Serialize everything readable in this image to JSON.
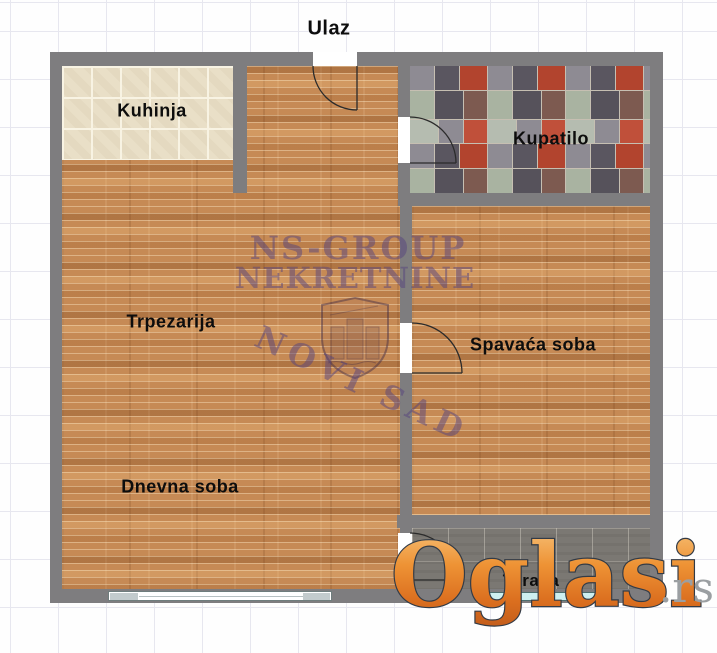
{
  "plan": {
    "entrance_label": "Ulaz",
    "rooms": {
      "kitchen": "Kuhinja",
      "bathroom": "Kupatilo",
      "dining": "Trpezarija",
      "bedroom": "Spavaća soba",
      "living": "Dnevna soba",
      "terrace": "Terasa"
    }
  },
  "watermark": {
    "agency_line1": "NS-GROUP",
    "agency_line2": "NEKRETNINE",
    "city": "NOVI SAD"
  },
  "logo": {
    "name": "Oglasi",
    "tld": ".rs"
  },
  "colors": {
    "wood_floor": "#c68a55",
    "wall_gray": "#7e7d7f",
    "kitchen_tile": "#e9dfc7",
    "terrace_concrete": "#7b7873",
    "logo_orange": "#e8842d",
    "watermark_purple": "rgba(86,68,126,0.5)",
    "label_black": "#0d0d0d"
  }
}
